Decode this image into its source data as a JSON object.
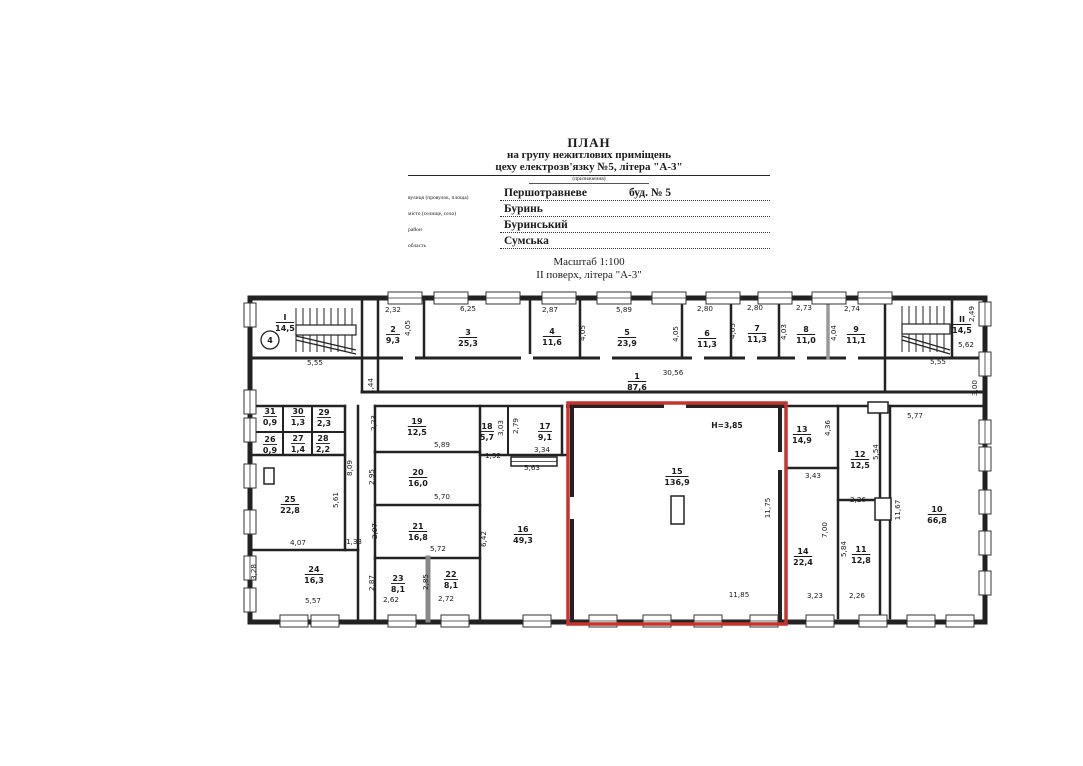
{
  "header": {
    "title": "ПЛАН",
    "subtitle1": "на групу нежитлових приміщень",
    "subtitle2": "цеху електрозв'язку №5, літера \"А-3\"",
    "purpose_note": "(призначення)",
    "fields": [
      {
        "label": "вулиця (провулок, площа)",
        "value": "Першотравневе",
        "value2": "буд. № 5"
      },
      {
        "label": "місто (селище, село)",
        "value": "Буринь",
        "value2": ""
      },
      {
        "label": "район",
        "value": "Буринський",
        "value2": ""
      },
      {
        "label": "область",
        "value": "Сумська",
        "value2": ""
      }
    ],
    "scale": "Масштаб 1:100",
    "floor": "ІІ поверх, літера \"А-3\""
  },
  "plan": {
    "ink_color": "#222222",
    "highlight_color": "#c5342f",
    "highlighted_room": "15",
    "height_note": "H=3,85",
    "axis_marker": "4",
    "rooms": [
      {
        "id": "І",
        "area": "14,5",
        "x": 285,
        "y": 322
      },
      {
        "id": "1",
        "area": "87,6",
        "x": 637,
        "y": 381
      },
      {
        "id": "2",
        "area": "9,3",
        "x": 393,
        "y": 334
      },
      {
        "id": "3",
        "area": "25,3",
        "x": 468,
        "y": 337
      },
      {
        "id": "4",
        "area": "11,6",
        "x": 552,
        "y": 336
      },
      {
        "id": "5",
        "area": "23,9",
        "x": 627,
        "y": 337
      },
      {
        "id": "6",
        "area": "11,3",
        "x": 707,
        "y": 338
      },
      {
        "id": "7",
        "area": "11,3",
        "x": 757,
        "y": 333
      },
      {
        "id": "8",
        "area": "11,0",
        "x": 806,
        "y": 334
      },
      {
        "id": "9",
        "area": "11,1",
        "x": 856,
        "y": 334
      },
      {
        "id": "ІІ",
        "area": "14,5",
        "x": 962,
        "y": 324
      },
      {
        "id": "10",
        "area": "66,8",
        "x": 937,
        "y": 514
      },
      {
        "id": "11",
        "area": "12,8",
        "x": 861,
        "y": 554
      },
      {
        "id": "12",
        "area": "12,5",
        "x": 860,
        "y": 459
      },
      {
        "id": "13",
        "area": "14,9",
        "x": 802,
        "y": 434
      },
      {
        "id": "14",
        "area": "22,4",
        "x": 803,
        "y": 556
      },
      {
        "id": "15",
        "area": "136,9",
        "x": 677,
        "y": 476
      },
      {
        "id": "16",
        "area": "49,3",
        "x": 523,
        "y": 534
      },
      {
        "id": "17",
        "area": "9,1",
        "x": 545,
        "y": 431
      },
      {
        "id": "18",
        "area": "5,7",
        "x": 487,
        "y": 431
      },
      {
        "id": "19",
        "area": "12,5",
        "x": 417,
        "y": 426
      },
      {
        "id": "20",
        "area": "16,0",
        "x": 418,
        "y": 477
      },
      {
        "id": "21",
        "area": "16,8",
        "x": 418,
        "y": 531
      },
      {
        "id": "22",
        "area": "8,1",
        "x": 451,
        "y": 579
      },
      {
        "id": "23",
        "area": "8,1",
        "x": 398,
        "y": 583
      },
      {
        "id": "24",
        "area": "16,3",
        "x": 314,
        "y": 574
      },
      {
        "id": "25",
        "area": "22,8",
        "x": 290,
        "y": 504
      },
      {
        "id": "26",
        "area": "0,9",
        "x": 270,
        "y": 444
      },
      {
        "id": "27",
        "area": "1,4",
        "x": 298,
        "y": 443
      },
      {
        "id": "28",
        "area": "2,2",
        "x": 323,
        "y": 443
      },
      {
        "id": "29",
        "area": "2,3",
        "x": 324,
        "y": 417
      },
      {
        "id": "30",
        "area": "1,3",
        "x": 298,
        "y": 416
      },
      {
        "id": "31",
        "area": "0,9",
        "x": 270,
        "y": 416
      }
    ],
    "dims": [
      {
        "t": "5,55",
        "x": 315,
        "y": 365
      },
      {
        "t": "1,44",
        "x": 373,
        "y": 386,
        "r": 1
      },
      {
        "t": "2,32",
        "x": 393,
        "y": 312
      },
      {
        "t": "6,25",
        "x": 468,
        "y": 311
      },
      {
        "t": "4,05",
        "x": 410,
        "y": 328,
        "r": 1
      },
      {
        "t": "2,87",
        "x": 550,
        "y": 312
      },
      {
        "t": "4,05",
        "x": 585,
        "y": 333,
        "r": 1
      },
      {
        "t": "5,89",
        "x": 624,
        "y": 312
      },
      {
        "t": "4,05",
        "x": 678,
        "y": 334,
        "r": 1
      },
      {
        "t": "2,80",
        "x": 705,
        "y": 311
      },
      {
        "t": "4,05",
        "x": 735,
        "y": 331,
        "r": 1
      },
      {
        "t": "2,80",
        "x": 755,
        "y": 310
      },
      {
        "t": "2,73",
        "x": 804,
        "y": 310
      },
      {
        "t": "4,03",
        "x": 786,
        "y": 332,
        "r": 1
      },
      {
        "t": "2,74",
        "x": 852,
        "y": 311
      },
      {
        "t": "4,04",
        "x": 836,
        "y": 333,
        "r": 1
      },
      {
        "t": "30,56",
        "x": 673,
        "y": 375
      },
      {
        "t": "2,49",
        "x": 974,
        "y": 314,
        "r": 1
      },
      {
        "t": "5,62",
        "x": 966,
        "y": 347
      },
      {
        "t": "3,00",
        "x": 977,
        "y": 388,
        "r": 1
      },
      {
        "t": "5,55",
        "x": 938,
        "y": 364
      },
      {
        "t": "2,23",
        "x": 376,
        "y": 423,
        "r": 1
      },
      {
        "t": "5,89",
        "x": 442,
        "y": 447
      },
      {
        "t": "3,03",
        "x": 503,
        "y": 428,
        "r": 1
      },
      {
        "t": "1,92",
        "x": 493,
        "y": 458
      },
      {
        "t": "2,79",
        "x": 518,
        "y": 426,
        "r": 1
      },
      {
        "t": "3,34",
        "x": 542,
        "y": 452
      },
      {
        "t": "5,63",
        "x": 532,
        "y": 470
      },
      {
        "t": "2,95",
        "x": 374,
        "y": 477,
        "r": 1
      },
      {
        "t": "5,70",
        "x": 442,
        "y": 499
      },
      {
        "t": "8,09",
        "x": 352,
        "y": 468,
        "r": 1
      },
      {
        "t": "5,61",
        "x": 338,
        "y": 500,
        "r": 1
      },
      {
        "t": "2,97",
        "x": 377,
        "y": 531,
        "r": 1
      },
      {
        "t": "5,72",
        "x": 438,
        "y": 551
      },
      {
        "t": "4,07",
        "x": 298,
        "y": 545
      },
      {
        "t": "1,33",
        "x": 354,
        "y": 544
      },
      {
        "t": "3,28",
        "x": 256,
        "y": 572,
        "r": 1
      },
      {
        "t": "5,57",
        "x": 313,
        "y": 603
      },
      {
        "t": "2,87",
        "x": 374,
        "y": 583,
        "r": 1
      },
      {
        "t": "2,62",
        "x": 391,
        "y": 602
      },
      {
        "t": "2,85",
        "x": 428,
        "y": 582,
        "r": 1
      },
      {
        "t": "2,72",
        "x": 446,
        "y": 601
      },
      {
        "t": "6,42",
        "x": 486,
        "y": 539,
        "r": 1
      },
      {
        "t": "11,75",
        "x": 770,
        "y": 508,
        "r": 1
      },
      {
        "t": "11,85",
        "x": 739,
        "y": 597
      },
      {
        "t": "4,36",
        "x": 830,
        "y": 428,
        "r": 1
      },
      {
        "t": "3,43",
        "x": 813,
        "y": 478
      },
      {
        "t": "5,54",
        "x": 878,
        "y": 452,
        "r": 1
      },
      {
        "t": "5,77",
        "x": 915,
        "y": 418
      },
      {
        "t": "7,00",
        "x": 827,
        "y": 530,
        "r": 1
      },
      {
        "t": "5,84",
        "x": 846,
        "y": 549,
        "r": 1
      },
      {
        "t": "2,26",
        "x": 858,
        "y": 502
      },
      {
        "t": "11,67",
        "x": 900,
        "y": 510,
        "r": 1
      },
      {
        "t": "3,23",
        "x": 815,
        "y": 598
      },
      {
        "t": "2,26",
        "x": 857,
        "y": 598
      }
    ]
  }
}
